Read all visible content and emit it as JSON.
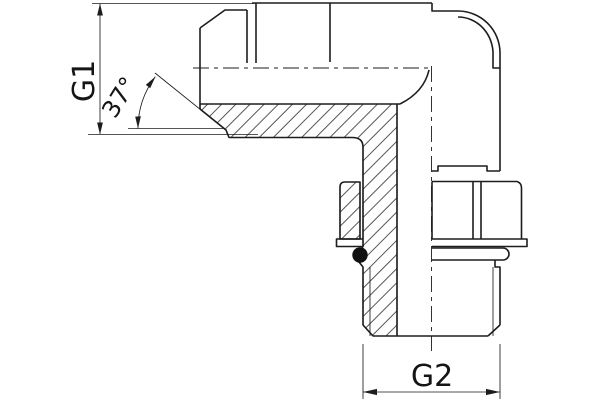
{
  "drawing": {
    "labels": {
      "g1": "G1",
      "angle": "37°",
      "g2": "G2"
    },
    "colors": {
      "line": "#1d1d1d",
      "background": "#ffffff",
      "o_ring_fill": "#111111"
    }
  }
}
